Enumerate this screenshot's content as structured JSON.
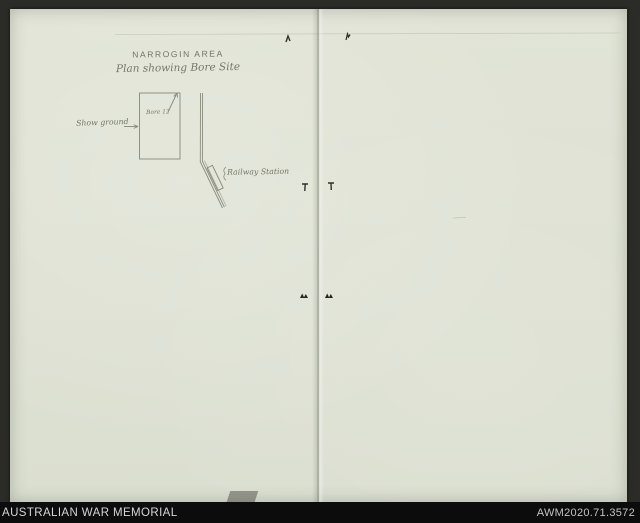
{
  "plan": {
    "title": "NARROGIN AREA",
    "subtitle": "Plan showing Bore Site",
    "labels": {
      "bore": "Bore 12",
      "showground": "Show ground",
      "railway_station": "Railway Station"
    }
  },
  "footer": {
    "institution": "AUSTRALIAN WAR MEMORIAL",
    "accession": "AWM2020.71.3572"
  },
  "colors": {
    "paper": "#e0e3d5",
    "pencil": "#71746a",
    "scan_background": "#2b2b28",
    "footer_background": "#0c0c0c",
    "footer_text": "#d6d6d6"
  }
}
